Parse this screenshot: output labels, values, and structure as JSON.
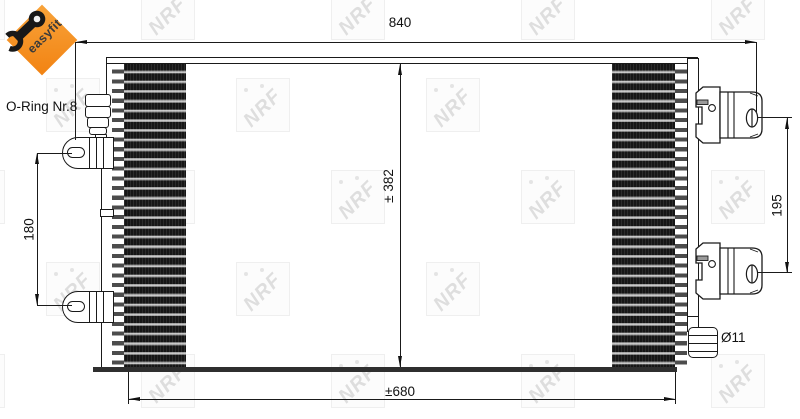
{
  "badge": {
    "label": "easyfit",
    "bg_color": "#f6921e"
  },
  "watermark": {
    "text": "NRF"
  },
  "annotations": {
    "o_ring": "O-Ring Nr.8",
    "pipe_diameter": "Ø11"
  },
  "dimensions": {
    "overall_width": "840",
    "core_height": "± 382",
    "core_width": "±680",
    "bracket_spacing": "180",
    "port_spacing": "195"
  },
  "colors": {
    "accent_orange": "#f6921e",
    "line": "#1a1a1a"
  }
}
